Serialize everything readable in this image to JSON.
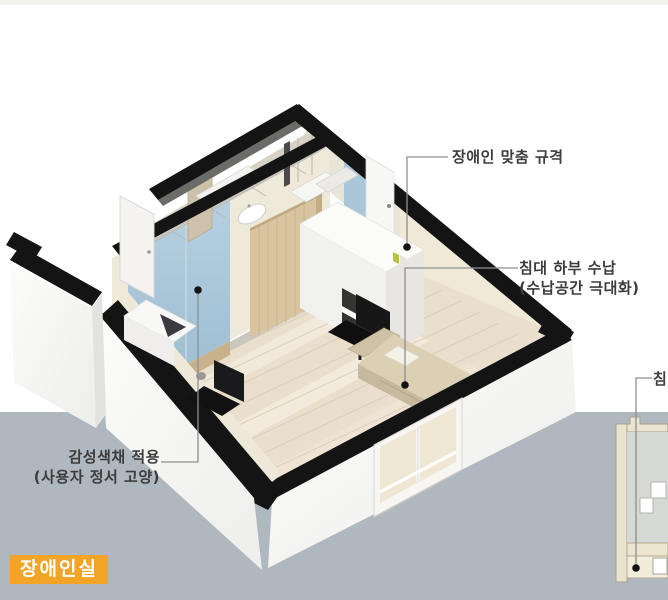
{
  "badge": {
    "label": "장애인실"
  },
  "annotations": {
    "custom_spec": {
      "line1": "장애인 맞춤 규격"
    },
    "bed_storage": {
      "line1": "침대 하부 수납",
      "line2": "(수납공간 극대화)"
    },
    "emotional_color": {
      "line1": "감성색채 적용",
      "line2": "(사용자 정서 고양)"
    },
    "side_section_bed": {
      "line1": "침대"
    }
  },
  "palette": {
    "background_top": "#ffffff",
    "background_bottom": "#afb8bf",
    "cut_wall_black": "#141414",
    "accent_wall_blue": "#a9c7d9",
    "wood_door_tan": "#d8c49e",
    "bed_beige": "#dbcfb4",
    "floor_wood": "#eadfcc",
    "bathroom_tile": "#d8d2c6",
    "badge_orange": "#f2a427",
    "label_text": "#3c3c3c",
    "leader_line": "#8f8f8f"
  }
}
